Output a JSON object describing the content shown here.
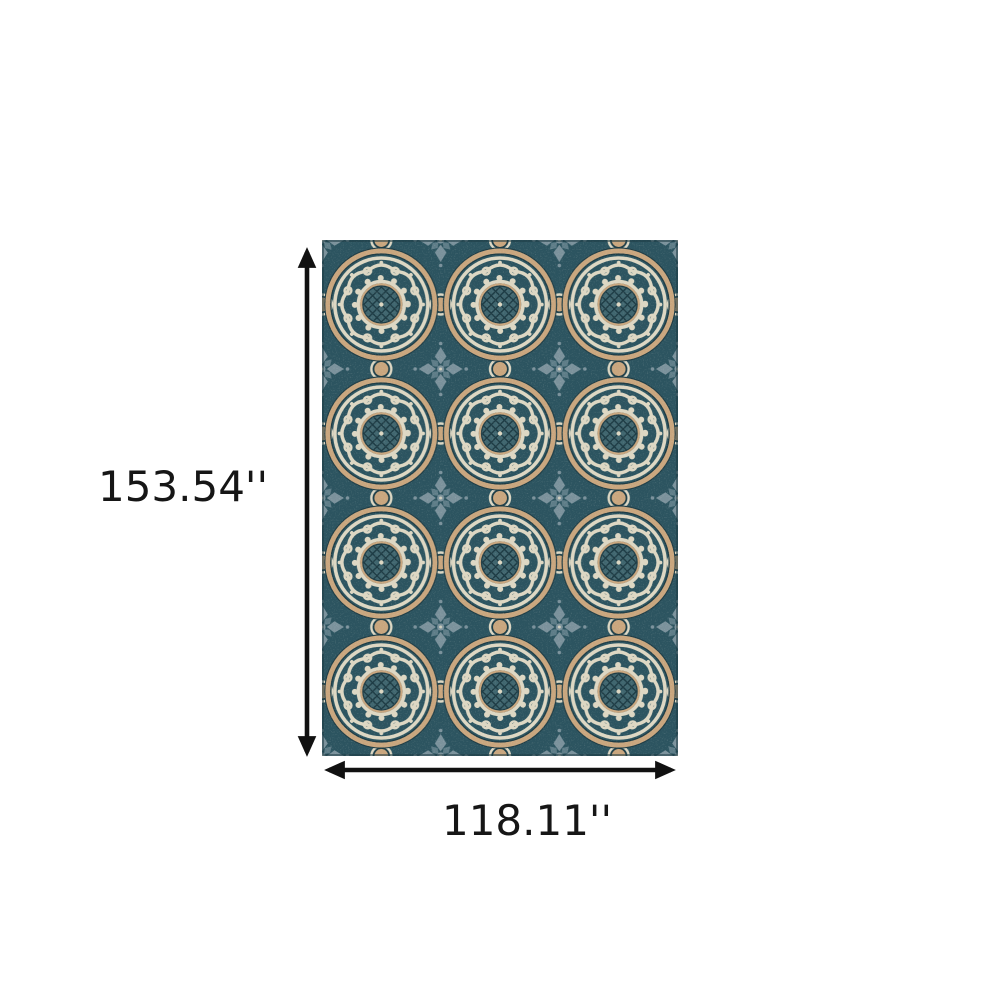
{
  "page": {
    "background": "#ffffff"
  },
  "diagram": {
    "type": "product-dimensions",
    "item": "blue and gray floral medallion area rug",
    "height_label": "153.54''",
    "width_label": "118.11''",
    "units": "inches",
    "vertical_arrow_icon": "double-headed-arrow-vertical",
    "horizontal_arrow_icon": "double-headed-arrow-horizontal"
  },
  "rug": {
    "pattern": "interlocking circular medallions with scrollwork, scalloped gear rings, lattice centers, tan dot accents and gray-blue floral diamonds",
    "grid": {
      "columns": 3,
      "rows": 4
    }
  },
  "colors": {
    "page_bg": "#ffffff",
    "text": "#161616",
    "arrow": "#111111",
    "base_teal": "#2c5460",
    "center_teal": "#40666f",
    "cream": "#ddd7c3",
    "tan": "#c9a67e",
    "gray_blue": "#7b929c",
    "gray_blue_dark": "#5e7d88",
    "outline_dark": "#1d3b44"
  }
}
